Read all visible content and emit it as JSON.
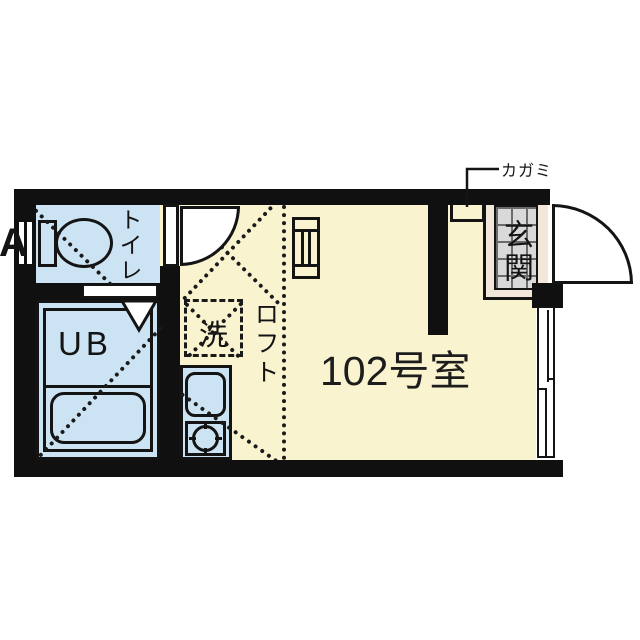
{
  "plan": {
    "room_label": "102号室",
    "entrance_label": "玄関",
    "mirror_label": "カガミ",
    "loft_label": "ロフト",
    "washer_label": "洗",
    "bath_label": "UB",
    "toilet_label": "トイレ",
    "vent_label": "A"
  },
  "colors": {
    "wall": "#101010",
    "floor_yellow": "#F9F3CF",
    "wet_area_blue": "#CBE3F3",
    "entrance_tile_grey": "#D9D9D9",
    "entrance_margin_cream": "#F2E8DA",
    "line_black": "#141414"
  }
}
